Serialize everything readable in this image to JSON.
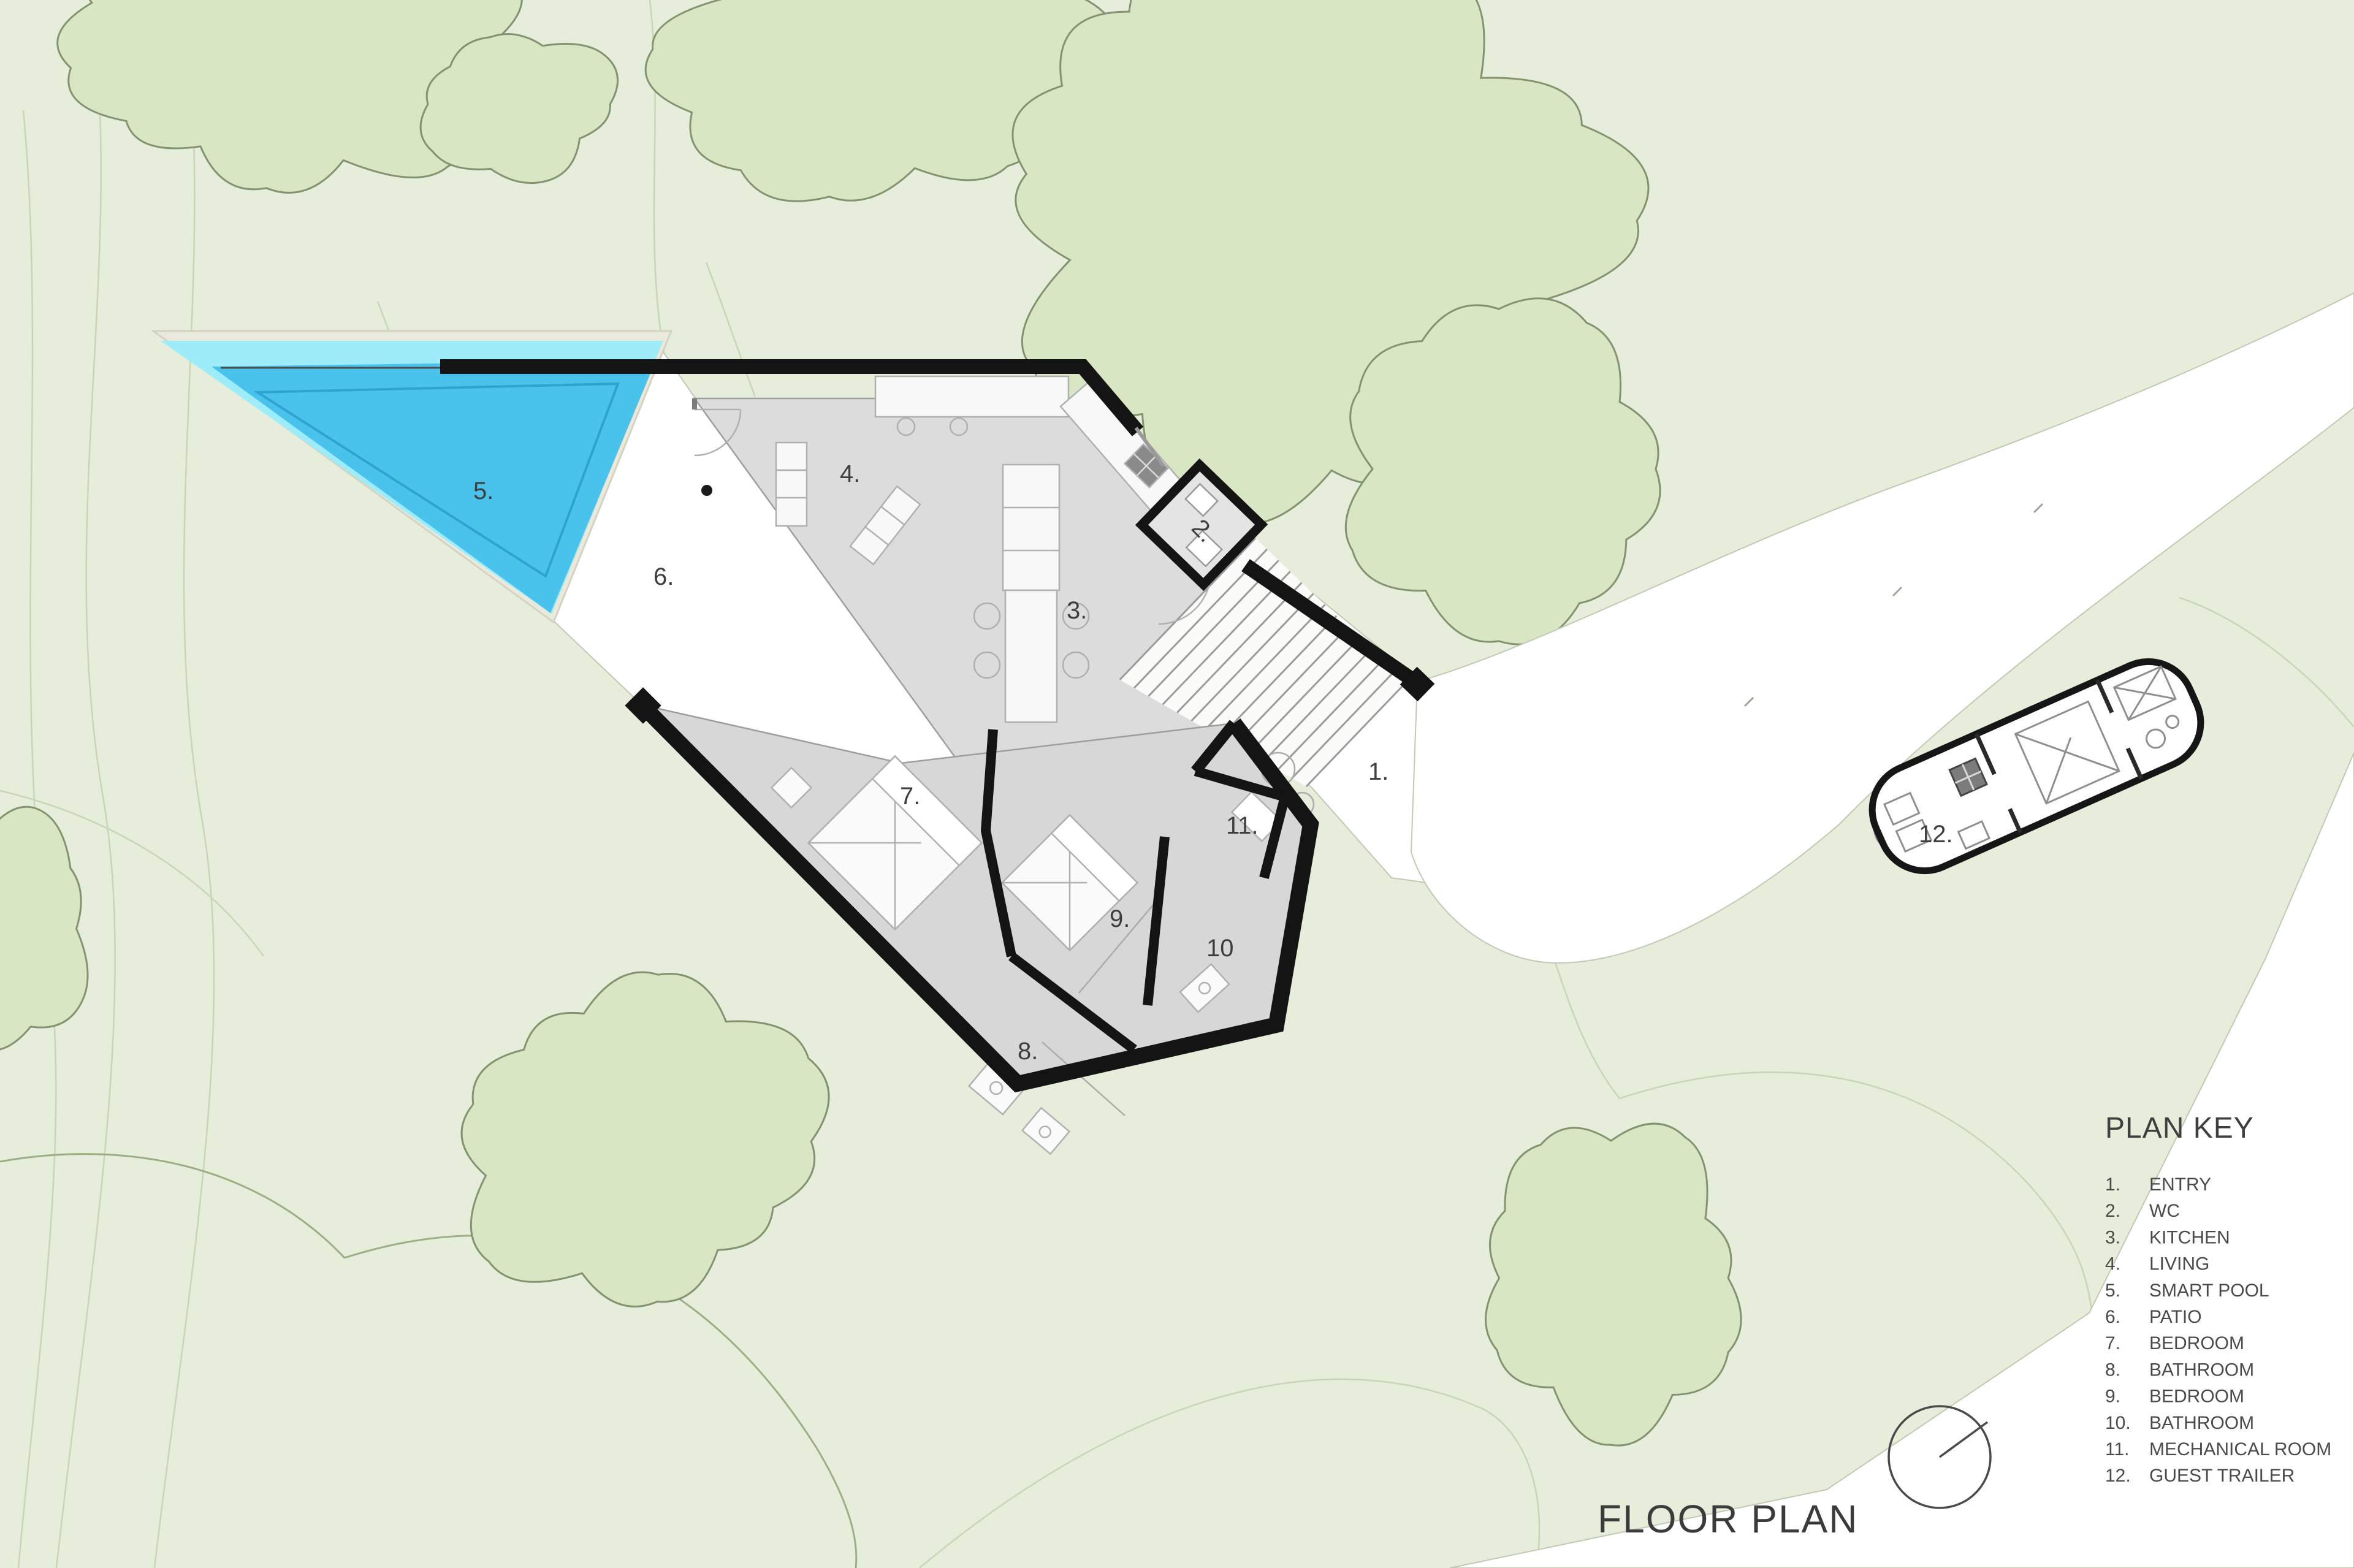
{
  "site": {
    "ground_color": "#E6EDDA",
    "tree_fill": "#D9E6C3",
    "tree_outline": "#82946F",
    "contour_color": "#C8D5B7",
    "contour_dark": "#9CAF84",
    "path_fill": "#FFFFFF",
    "path_edge": "#C2C9B3"
  },
  "pool": {
    "coping_color": "#EAE9DC",
    "edge_band_color": "#9EEBFA",
    "water_color": "#49C3EC",
    "water_line_color": "#2FA3CF"
  },
  "building": {
    "wall_color": "#141414",
    "floor_upper_color": "#DCDCDC",
    "floor_lower_color": "#D7D7D7",
    "floor_edge_color": "#9E9E9E",
    "furniture_fill": "#F8F8F8",
    "furniture_edge": "#B0B0B0",
    "stair_line_color": "#9B9B9B"
  },
  "room_labels": [
    "1.",
    "2.",
    "3.",
    "4.",
    "5.",
    "6.",
    "7.",
    "8.",
    "9.",
    "10",
    "11.",
    "12."
  ],
  "plan_key": {
    "title": "PLAN KEY",
    "items": [
      {
        "num": "1.",
        "label": "ENTRY"
      },
      {
        "num": "2.",
        "label": "WC"
      },
      {
        "num": "3.",
        "label": "KITCHEN"
      },
      {
        "num": "4.",
        "label": "LIVING"
      },
      {
        "num": "5.",
        "label": "SMART POOL"
      },
      {
        "num": "6.",
        "label": "PATIO"
      },
      {
        "num": "7.",
        "label": "BEDROOM"
      },
      {
        "num": "8.",
        "label": "BATHROOM"
      },
      {
        "num": "9.",
        "label": "BEDROOM"
      },
      {
        "num": "10.",
        "label": "BATHROOM"
      },
      {
        "num": "11.",
        "label": "MECHANICAL ROOM"
      },
      {
        "num": "12.",
        "label": "GUEST TRAILER"
      }
    ]
  },
  "title_block": {
    "drawing_title": "FLOOR PLAN"
  },
  "north_indicator": {
    "shape": "circle-with-bearing-line"
  }
}
